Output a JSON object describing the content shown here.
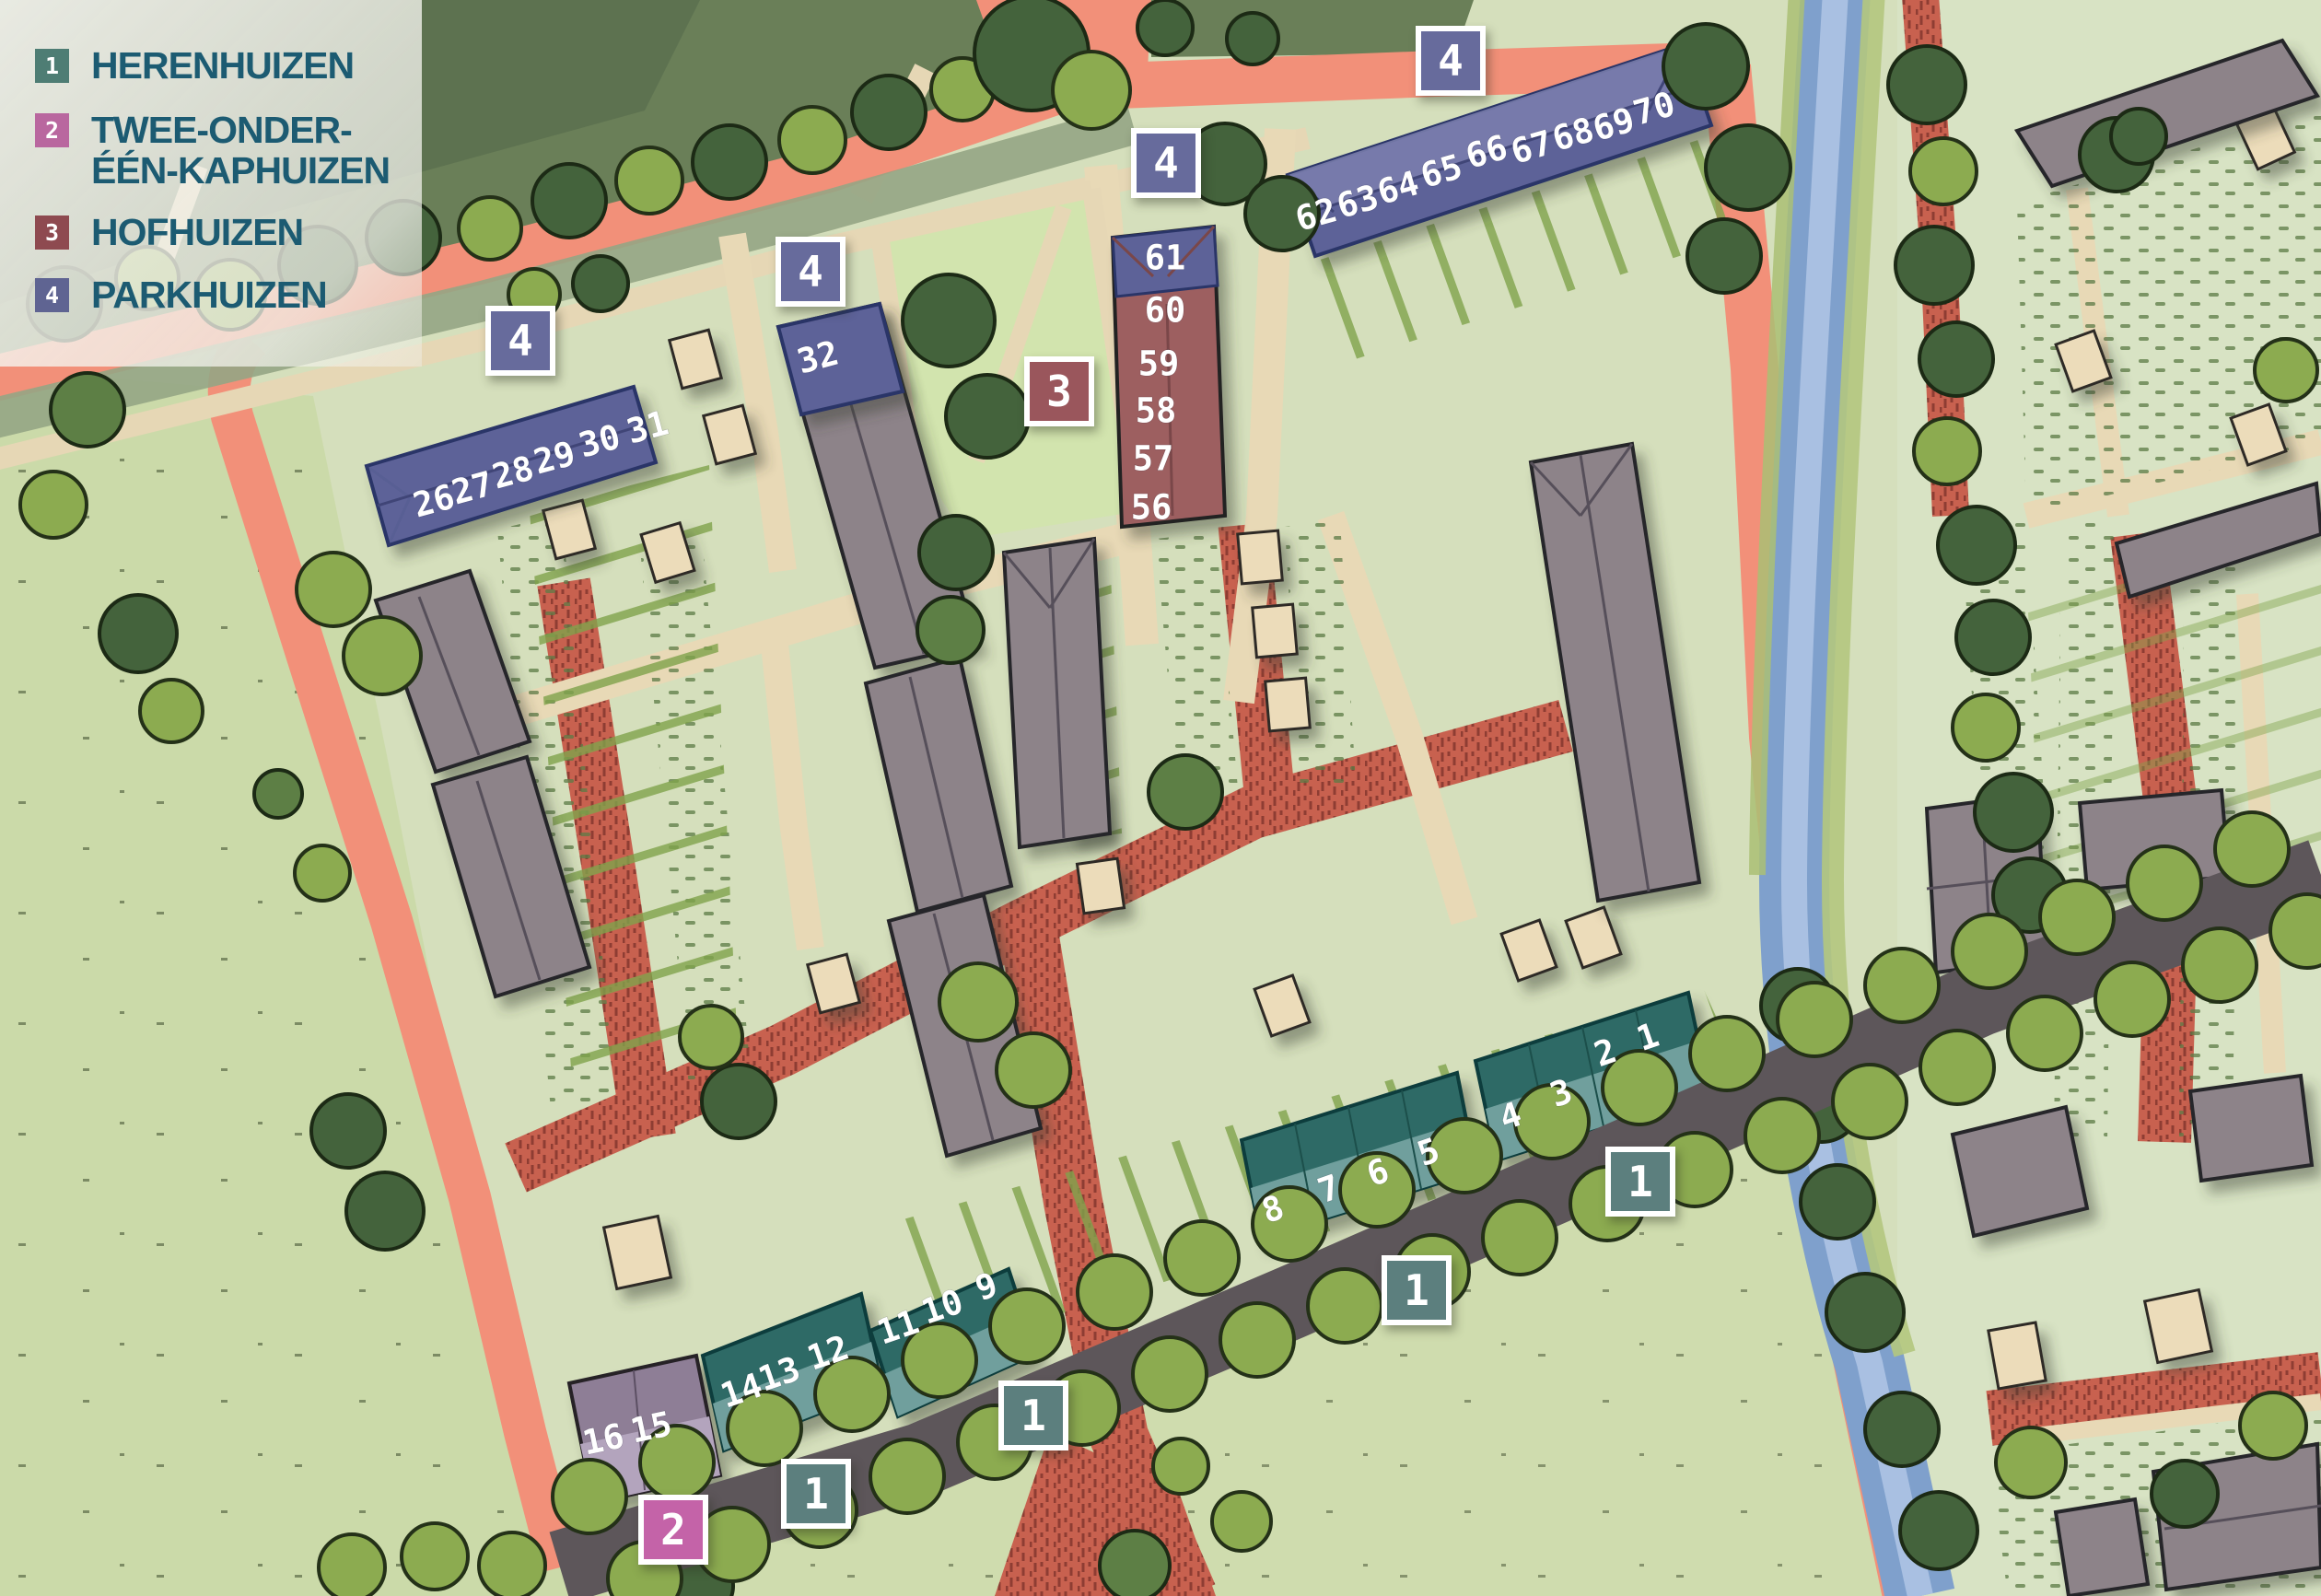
{
  "legend": {
    "items": [
      {
        "num": "1",
        "label": "HERENHUIZEN",
        "color": "#4e7d74"
      },
      {
        "num": "2",
        "label": "TWEE-ONDER-ÉÉN-KAPHUIZEN",
        "color": "#b9679f"
      },
      {
        "num": "3",
        "label": "HOFHUIZEN",
        "color": "#8e4a50"
      },
      {
        "num": "4",
        "label": "PARKHUIZEN",
        "color": "#5f6492"
      }
    ]
  },
  "badges": {
    "herenhuizen": "1",
    "twee_onder_een_kap": "2",
    "hofhuizen": "3",
    "parkhuizen": "4"
  },
  "plots": {
    "parkhuizen_west": [
      "26",
      "27",
      "28",
      "29",
      "30",
      "31"
    ],
    "parkhuizen_mid": [
      "32"
    ],
    "parkhuizen_row": [
      "62",
      "63",
      "64",
      "65",
      "66",
      "67",
      "68",
      "69",
      "70"
    ],
    "parkhuizen_hof": [
      "61"
    ],
    "hofhuizen": [
      "60",
      "59",
      "58",
      "57",
      "56"
    ],
    "herenhuizen_east": [
      "1",
      "2",
      "3",
      "4"
    ],
    "herenhuizen_mid": [
      "5",
      "6",
      "7",
      "8"
    ],
    "herenhuizen_south": [
      "9",
      "10",
      "11"
    ],
    "herenhuizen_southwest": [
      "12",
      "13",
      "14"
    ],
    "kaphuizen": [
      "15",
      "16"
    ]
  },
  "colors": {
    "road_salmon": "#f29079",
    "road_dark": "#5d565a",
    "brick_path": "#c8614f",
    "canal_blue": "#7fa0cc",
    "field_green": "#cbdaa9",
    "parkhuizen_building": "#5d6298",
    "hofhuizen_building": "#9d5f61",
    "herenhuizen_building_dark": "#2e6b66",
    "herenhuizen_building_light": "#6f9f9d",
    "kaphuizen_building": "#b3a4bd",
    "legend_text": "#1c5b72"
  }
}
